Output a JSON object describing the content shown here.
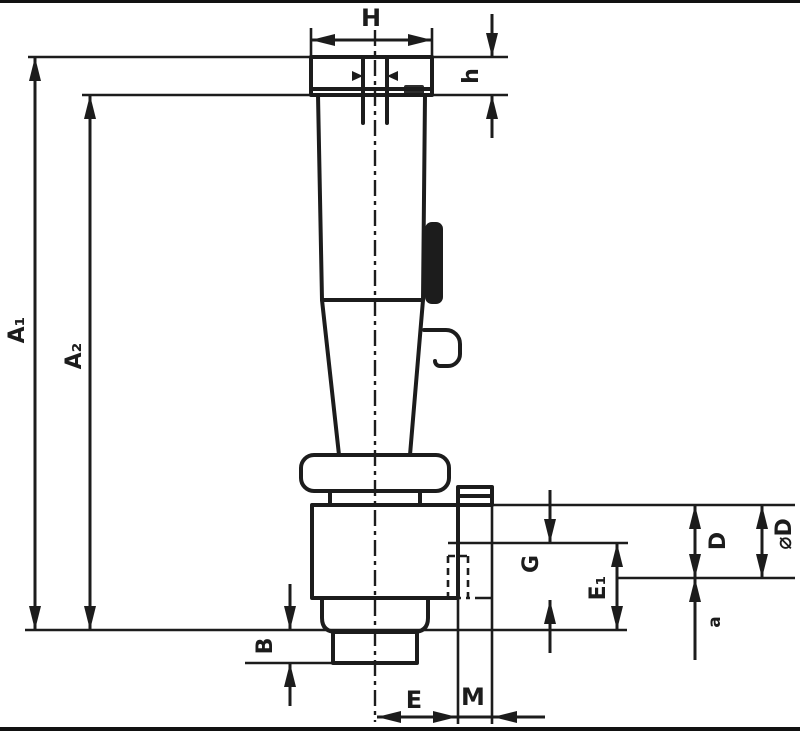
{
  "drawing": {
    "colors": {
      "ink": "#1c1c1c",
      "background": "#ffffff"
    },
    "dimension_labels": {
      "top_width": "H",
      "head_height": "h",
      "overall_length": "A₁",
      "body_length": "A₂",
      "collar_depth": "G",
      "socket_depth": "E₁",
      "diameter": "D",
      "outer_diameter": "⌀D",
      "step": "a",
      "base_height": "B",
      "bottom_width": "E",
      "pin_offset": "M"
    }
  }
}
